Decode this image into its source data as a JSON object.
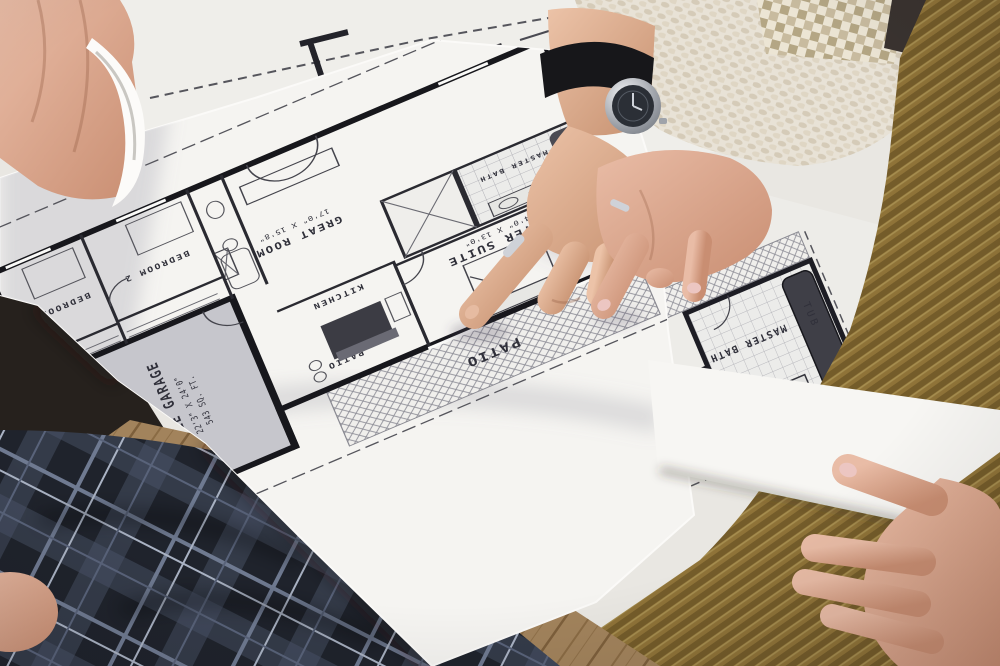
{
  "scene": {
    "description": "Overhead photo of two people reviewing architectural floor plan blueprints on a table",
    "type": "photograph"
  },
  "blueprint": {
    "sheet1": {
      "rooms": [
        {
          "name": "DOUBLE GARAGE",
          "dims": "22'3\" X 24'0\"",
          "area": "543 SQ. FT."
        },
        {
          "name": "GREAT ROOM",
          "dims": "17'0\" X 15'8\""
        },
        {
          "name": "KITCHEN"
        },
        {
          "name": "MASTER SUITE",
          "dims": "14'0\" X 13'0\""
        },
        {
          "name": "MASTER BATH"
        },
        {
          "name": "BEDROOM 2"
        },
        {
          "name": "BEDROOM 3"
        },
        {
          "name": "PATIO"
        },
        {
          "name": "PATIO"
        }
      ]
    },
    "sheet2": {
      "labels": [
        {
          "text": "MASTER BATH"
        },
        {
          "text": "TUB"
        }
      ]
    }
  },
  "photo": {
    "colors": {
      "paper": "#f4f3f0",
      "under_paper": "#ebeae6",
      "blueprint_ink": "#2a2a31",
      "garage_fill": "#c6c6cc",
      "skin": "#d9a88c",
      "knit_sweater": "#e6dfd2",
      "mustard_sweater": "#8f7338",
      "plaid_trousers": "#1f232c",
      "wood_floor": "#a2835c",
      "watch_strap": "#17171a",
      "watch_case": "#c8c9cd",
      "nail_polish": "#ecc6c2"
    },
    "objects": [
      "man-pointing-hand-with-watch",
      "woman-pointing-hand-with-ring",
      "hand-gripping-curled-corner",
      "hand-holding-sheet-edge",
      "floor-plan-sheet",
      "detail-sheet-master-bath"
    ]
  }
}
